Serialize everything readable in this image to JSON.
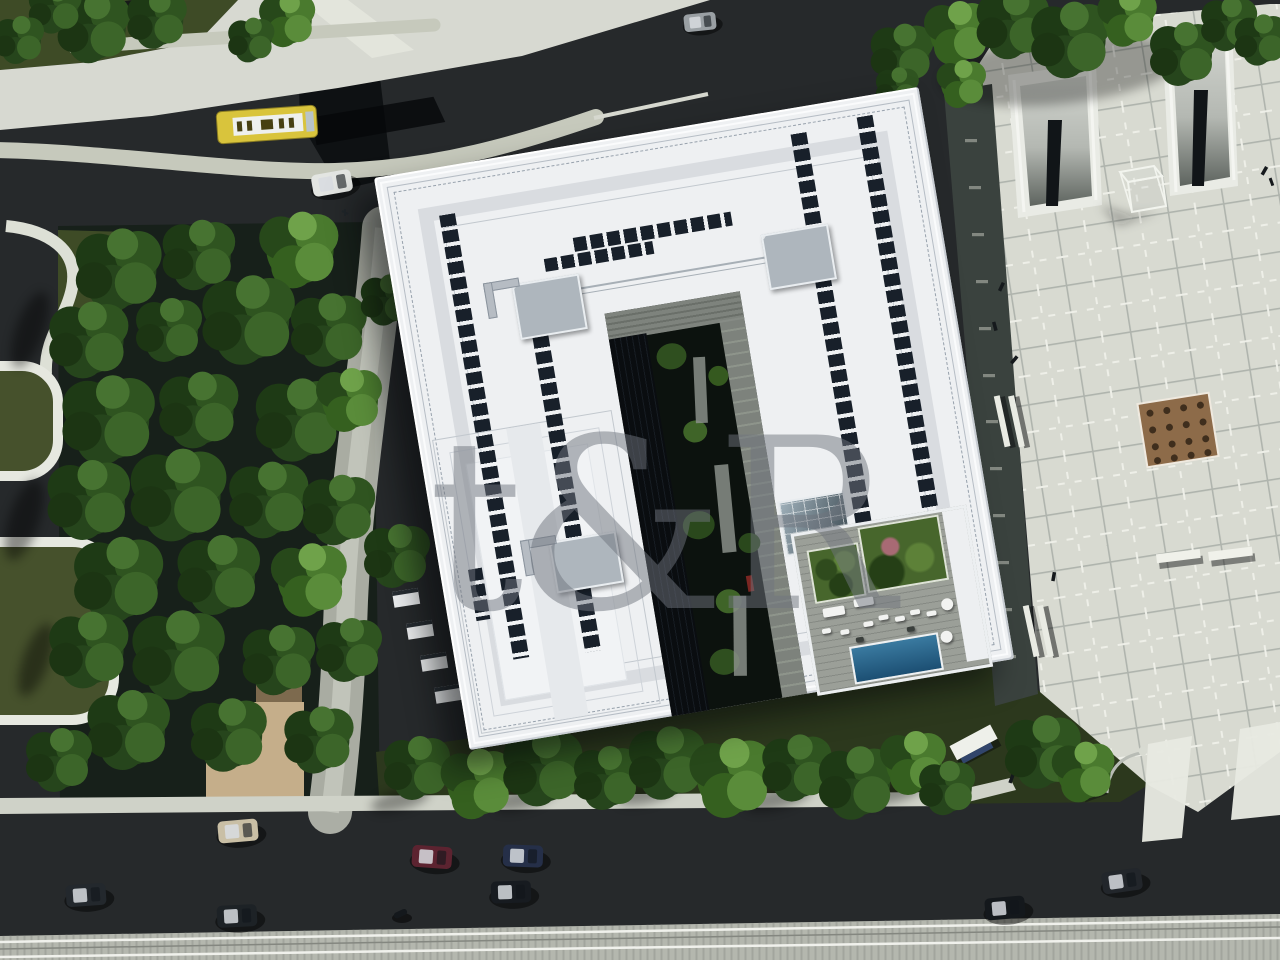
{
  "scene": {
    "description": "Aerial 3D architectural rendering: white U-shaped building with rooftop solar panel rows, inner green courtyard, rooftop pool terrace, park with trees on the left, roads with cars and a yellow bus, tram tracks at bottom, and a paved pedestrian plaza with sunken ramps on the right.",
    "watermark": {
      "text": "t&R"
    }
  },
  "palette": {
    "asphalt": "#26292b",
    "sidewalk": "#d7d9d1",
    "plaza": "#d8dad1",
    "plaza_band": "#3a423e",
    "park_ground": "#17201a",
    "grass_dark": "#3e4b26",
    "lawn": "#2c381d",
    "roof_white": "#eef0f2",
    "panel_navy": "#18202a",
    "courtyard_dark": "#0c120e",
    "deck_gray": "#9b9f98",
    "pool_blue": "#1c4f73",
    "bus_yellow": "#d9c43c",
    "tan_path": "#c5ae8a",
    "tram_band": "#b4b7ae",
    "watermark": "#70757e"
  }
}
